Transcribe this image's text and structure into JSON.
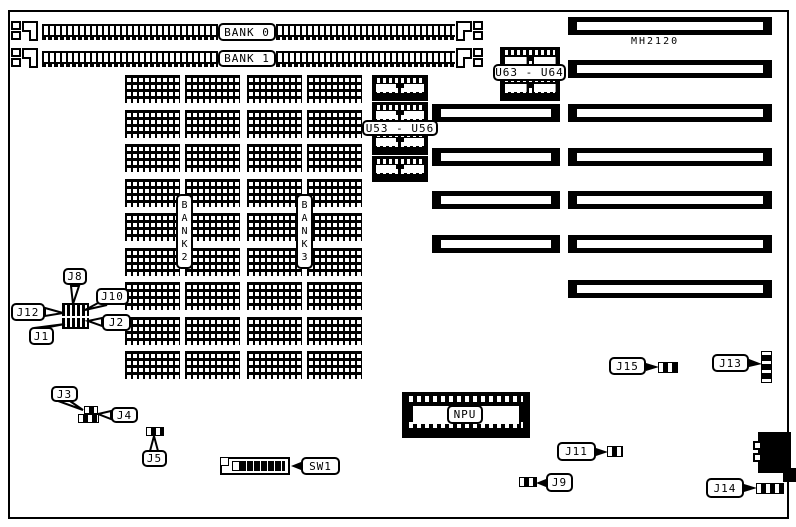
{
  "diagram": {
    "board_model": "MH2120",
    "memory": {
      "simm_banks": [
        "BANK 0",
        "BANK 1"
      ],
      "dram_banks": [
        "BANK2",
        "BANK3"
      ],
      "chip_ranges": {
        "u53_u56": "U53 - U56",
        "u63_u64": "U63 - U64"
      }
    },
    "components": {
      "npu": "NPU",
      "sw1": "SW1"
    },
    "jumpers": {
      "j1": "J1",
      "j2": "J2",
      "j3": "J3",
      "j4": "J4",
      "j5": "J5",
      "j8": "J8",
      "j9": "J9",
      "j10": "J10",
      "j11": "J11",
      "j12": "J12",
      "j13": "J13",
      "j14": "J14",
      "j15": "J15"
    },
    "colors": {
      "ink": "#000000",
      "paper": "#ffffff"
    }
  }
}
